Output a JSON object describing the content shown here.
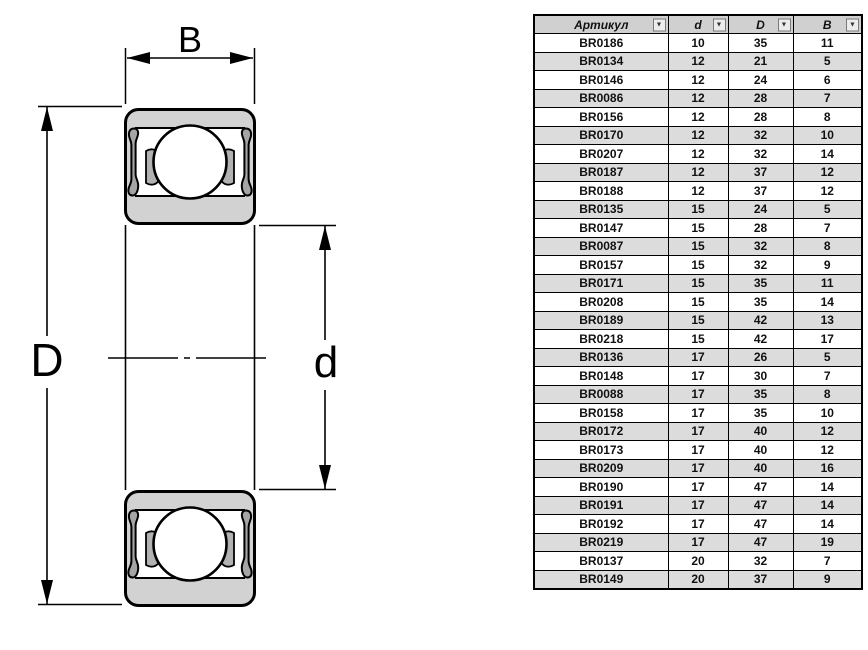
{
  "colors": {
    "page_bg": "#ffffff",
    "line_black": "#000000",
    "body_gray": "#d2d2d2",
    "seal_gray": "#a5a5a5",
    "cage_gray": "#b2b2b2",
    "ball_white": "#ffffff",
    "header_bg": "#d0d0d0",
    "stripe_bg": "#dcdcdc"
  },
  "diagram": {
    "labels": {
      "width": "B",
      "outer_diameter": "D",
      "bore_diameter": "d"
    }
  },
  "table": {
    "columns": [
      {
        "key": "article",
        "label": "Артикул"
      },
      {
        "key": "d",
        "label": "d"
      },
      {
        "key": "D",
        "label": "D"
      },
      {
        "key": "B",
        "label": "B"
      }
    ],
    "filter_icon": "▼",
    "rows": [
      [
        "BR0186",
        "10",
        "35",
        "11"
      ],
      [
        "BR0134",
        "12",
        "21",
        "5"
      ],
      [
        "BR0146",
        "12",
        "24",
        "6"
      ],
      [
        "BR0086",
        "12",
        "28",
        "7"
      ],
      [
        "BR0156",
        "12",
        "28",
        "8"
      ],
      [
        "BR0170",
        "12",
        "32",
        "10"
      ],
      [
        "BR0207",
        "12",
        "32",
        "14"
      ],
      [
        "BR0187",
        "12",
        "37",
        "12"
      ],
      [
        "BR0188",
        "12",
        "37",
        "12"
      ],
      [
        "BR0135",
        "15",
        "24",
        "5"
      ],
      [
        "BR0147",
        "15",
        "28",
        "7"
      ],
      [
        "BR0087",
        "15",
        "32",
        "8"
      ],
      [
        "BR0157",
        "15",
        "32",
        "9"
      ],
      [
        "BR0171",
        "15",
        "35",
        "11"
      ],
      [
        "BR0208",
        "15",
        "35",
        "14"
      ],
      [
        "BR0189",
        "15",
        "42",
        "13"
      ],
      [
        "BR0218",
        "15",
        "42",
        "17"
      ],
      [
        "BR0136",
        "17",
        "26",
        "5"
      ],
      [
        "BR0148",
        "17",
        "30",
        "7"
      ],
      [
        "BR0088",
        "17",
        "35",
        "8"
      ],
      [
        "BR0158",
        "17",
        "35",
        "10"
      ],
      [
        "BR0172",
        "17",
        "40",
        "12"
      ],
      [
        "BR0173",
        "17",
        "40",
        "12"
      ],
      [
        "BR0209",
        "17",
        "40",
        "16"
      ],
      [
        "BR0190",
        "17",
        "47",
        "14"
      ],
      [
        "BR0191",
        "17",
        "47",
        "14"
      ],
      [
        "BR0192",
        "17",
        "47",
        "14"
      ],
      [
        "BR0219",
        "17",
        "47",
        "19"
      ],
      [
        "BR0137",
        "20",
        "32",
        "7"
      ],
      [
        "BR0149",
        "20",
        "37",
        "9"
      ]
    ]
  }
}
